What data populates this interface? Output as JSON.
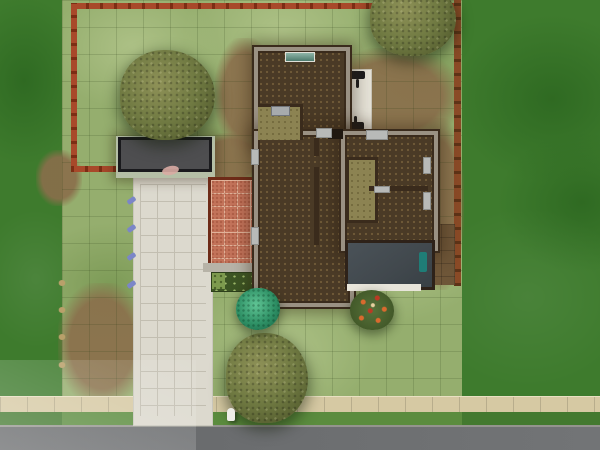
{
  "scene": {
    "title": "Suburban house lot - top-down view",
    "objects": {
      "lawn": "Lot lawn",
      "house": "House",
      "garage": "Garage",
      "driveway": "Driveway",
      "terracotta_patio": "Terracotta patio",
      "white_patio": "Back patio",
      "grill": "Barbecue grill",
      "garden_plot": "Garden plot",
      "tree": "Tree",
      "teal_shrub": "Round teal shrub",
      "flowering_shrub": "Flowering shrub",
      "fence": "Backyard fence",
      "hydrant": "Fire hydrant",
      "sprinkler": "Sprinkler head",
      "sidewalk": "Sidewalk",
      "road": "Road",
      "dark_room": "Dark-floored room",
      "teal_fixture": "Teal fixture"
    }
  },
  "palette": {
    "offlot_grass": "#3e7b2d",
    "offlot_grass_dark": "#2f6a22",
    "lot_grass": "#95ae6e",
    "lot_grass_light": "#adc186",
    "lot_grass_dark": "#7d9b57",
    "dirt": "#8a6e4b",
    "dirt_dark": "#6e5638",
    "fence_red": "#a8492a",
    "fence_red_dark": "#7c2d14",
    "fence_brown": "#8a4a26",
    "fence_brown_dark": "#5e3317",
    "garage_roof": "#4e4e50",
    "garage_roof_edge": "#1a1a1d",
    "garage_wall": "#b5bfa6",
    "driveway": "#dcd9ce",
    "driveway_line": "#c2beb1",
    "patio_tile": "#c3735a",
    "patio_grout": "#e2b39a",
    "patio_border": "#6e2b18",
    "walkway_gray": "#b7b3a7",
    "wall_dark": "#3a2b1c",
    "wall_top": "#9a9183",
    "floor_brown": "#4a3a26",
    "floor_dot": "#6f5a38",
    "floor_olive": "#8c8352",
    "floor_slate": "#41484d",
    "patio_white": "#e5e2d7",
    "porch_white": "#e8e5da",
    "window_gray": "#b8bab8",
    "sidewalk": "#d6c9a3",
    "verge_green": "#5b8c3e",
    "road": "#6b6d6f",
    "curb": "#94948e",
    "tree_olive": "#707a42",
    "tree_olive_light": "#8e9157",
    "tree_olive_dark": "#4c5429",
    "bush_teal": "#2e9065",
    "bush_green": "#57723a",
    "flower_orange": "#d96a2e",
    "flower_red": "#bb3a24",
    "garden_soil": "#3d5524",
    "garden_sprout": "#9db86a",
    "sprinkler_blue": "#7b86c8",
    "tuft_tan": "#b9a06a",
    "hydrant_white": "#eeeee8",
    "black_object": "#1c1c1e",
    "teal_object": "#1f7d77"
  }
}
